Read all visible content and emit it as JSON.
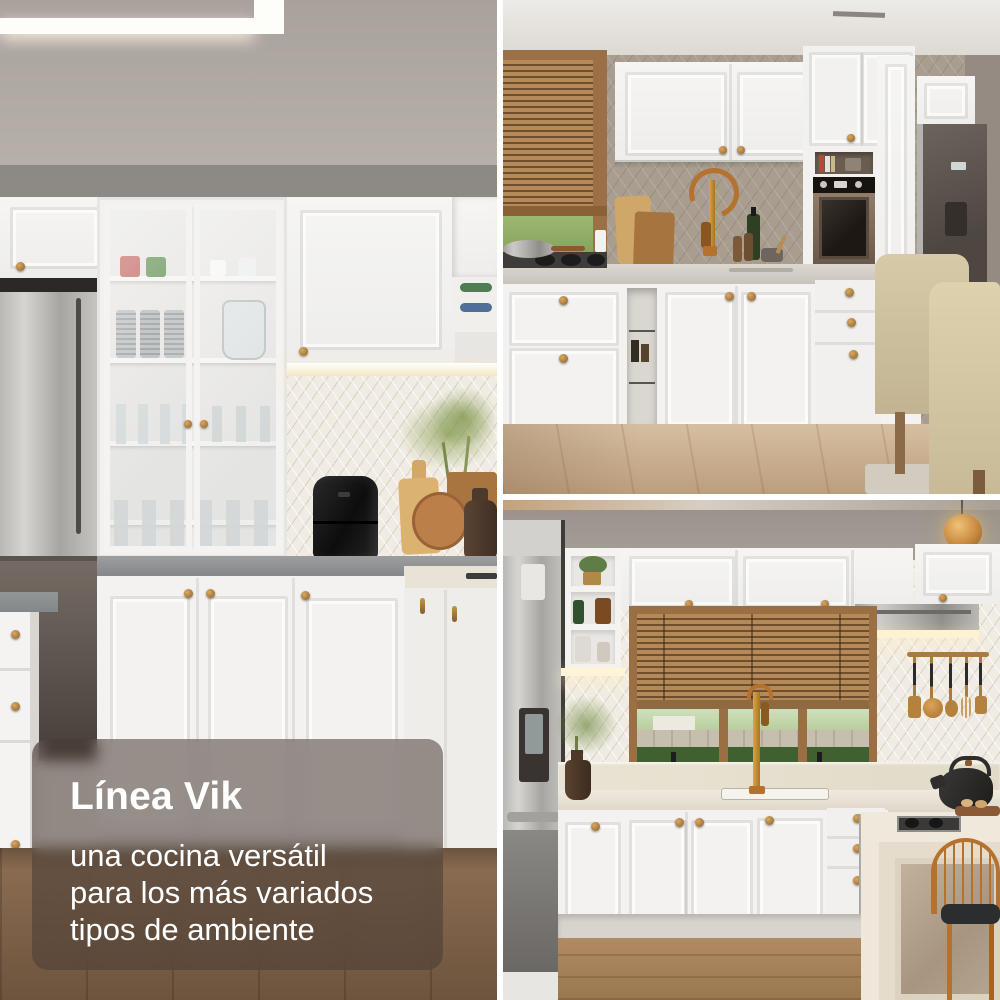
{
  "caption": {
    "title": "Línea Vik",
    "lines": [
      "una cocina versátil",
      "para los más variados",
      "tipos de ambiente"
    ]
  },
  "colors": {
    "caption_text": "#ffffff",
    "caption_panel": "#49342d",
    "collage_gap": "#ffffff",
    "cabinet_white": "#f4f3f1",
    "brass_knob": "#a97b3f",
    "copper_faucet": "#b5722f",
    "counter_gray": "#94979a",
    "ceiling_taupe": "#b2aba4",
    "wall_taupe": "#a89d8f",
    "backsplash_cream": "#f1ece3",
    "window_wood": "#9c7046",
    "blinds_wood": "#ad8457",
    "greenery_green": "#6f9a50",
    "steel_appliance": "#b3b1ae",
    "graphite_fridge": "#5b534c",
    "floor_wood_dark": "#85684e",
    "floor_wood_light": "#c9b090",
    "marble_island": "#e7ddcc",
    "black_appliance": "#1f1d1b"
  }
}
